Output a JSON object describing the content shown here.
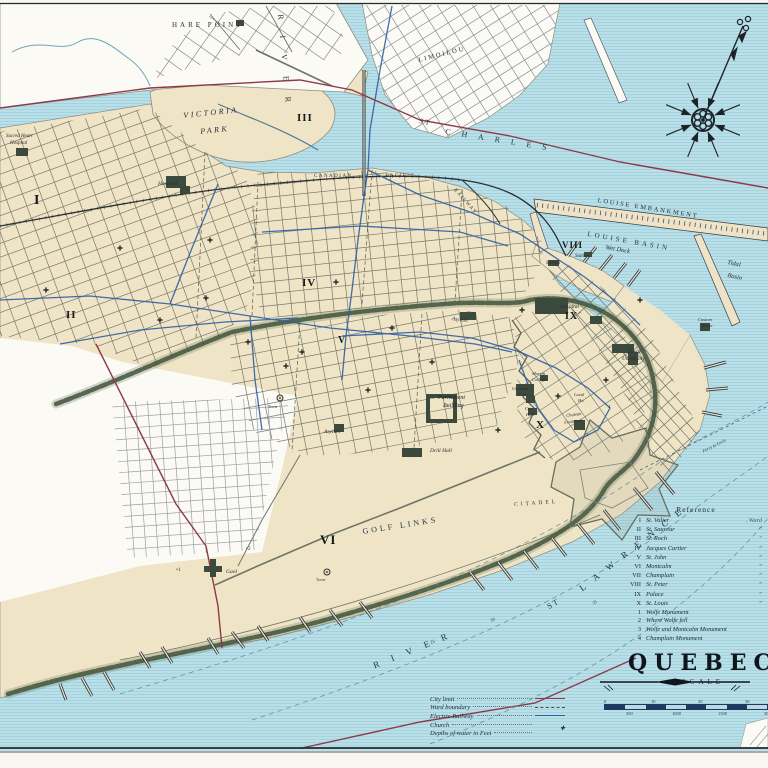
{
  "title": "QUEBEC",
  "scale": {
    "label": "SCALE",
    "top_ticks": [
      "0",
      "10",
      "20",
      "30"
    ],
    "bottom_ticks": [
      "500",
      "1000",
      "1500",
      "2000"
    ]
  },
  "legend": {
    "items": [
      {
        "label": "City limit",
        "type": "city-limit",
        "color": "#8c3a4a"
      },
      {
        "label": "Ward boundary",
        "type": "ward-boundary",
        "color": "#474c44"
      },
      {
        "label": "Electric Railway",
        "type": "electric-railway",
        "color": "#2e5fa3"
      },
      {
        "label": "Church",
        "type": "church",
        "symbol": "✚"
      },
      {
        "label": "Depths of water in Feet",
        "type": "none"
      }
    ]
  },
  "reference": {
    "title": "Reference",
    "ward_word": "Ward",
    "ditto": "”",
    "wards": [
      {
        "numeral": "I",
        "name": "St. Valier"
      },
      {
        "numeral": "II",
        "name": "St. Sauveur"
      },
      {
        "numeral": "III",
        "name": "St. Roch"
      },
      {
        "numeral": "IV",
        "name": "Jacques Cartier"
      },
      {
        "numeral": "V",
        "name": "St. John"
      },
      {
        "numeral": "VI",
        "name": "Montcalm"
      },
      {
        "numeral": "VII",
        "name": "Champlain"
      },
      {
        "numeral": "VIII",
        "name": "St. Peter"
      },
      {
        "numeral": "IX",
        "name": "Palace"
      },
      {
        "numeral": "X",
        "name": "St. Louis"
      }
    ],
    "monuments": [
      {
        "num": "1",
        "name": "Wolfe Monument"
      },
      {
        "num": "2",
        "name": "Where Wolfe fell"
      },
      {
        "num": "3",
        "name": "Wolfe and Montcalm Monument"
      },
      {
        "num": "4",
        "name": "Champlain Monument"
      }
    ]
  },
  "colors": {
    "water": "#b9dfe9",
    "water_line": "#97c8d5",
    "land": "#f0e4c6",
    "blank": "#fbfaf5",
    "cliff": "#41523c",
    "city_limit": "#8c3a4a",
    "electric": "#2e5fa3",
    "street": "#757b6c",
    "building": "#3c4a3e",
    "ink": "#23282f"
  },
  "map_labels": [
    {
      "t": "HARE  POINT",
      "x": 172,
      "y": 22,
      "s": 7,
      "ls": 3,
      "cls": "lb-caps"
    },
    {
      "t": "VICTORIA",
      "x": 183,
      "y": 112,
      "s": 8,
      "ls": 2.5,
      "r": -6,
      "cls": "lb-italic"
    },
    {
      "t": "PARK",
      "x": 200,
      "y": 128,
      "s": 8,
      "ls": 2.5,
      "r": -6,
      "cls": "lb-italic"
    },
    {
      "t": "RIVER",
      "x": 284,
      "y": 14,
      "s": 8,
      "ls": 16,
      "r": 85,
      "cls": "lb-water"
    },
    {
      "t": "ST",
      "x": 420,
      "y": 118,
      "s": 7,
      "ls": 2,
      "r": 12,
      "cls": "lb-water"
    },
    {
      "t": "CHARLES",
      "x": 446,
      "y": 128,
      "s": 8,
      "ls": 11,
      "r": 9,
      "cls": "lb-water"
    },
    {
      "t": "LIMOILOU",
      "x": 418,
      "y": 58,
      "s": 6.5,
      "ls": 2,
      "r": -14,
      "cls": "lb-caps"
    },
    {
      "t": "LOUISE  EMBANKMENT",
      "x": 598,
      "y": 198,
      "s": 6.5,
      "ls": 1.8,
      "r": 9,
      "cls": "lb-caps"
    },
    {
      "t": "LOUISE  BASIN",
      "x": 588,
      "y": 231,
      "s": 7,
      "ls": 3,
      "r": 10,
      "cls": "lb-water"
    },
    {
      "t": "Wet Dock",
      "x": 606,
      "y": 245,
      "s": 6.5,
      "r": 10,
      "cls": "lb-italic"
    },
    {
      "t": "Tidal",
      "x": 728,
      "y": 260,
      "s": 6.5,
      "r": 12,
      "cls": "lb-italic"
    },
    {
      "t": "Basin",
      "x": 728,
      "y": 273,
      "s": 6.5,
      "r": 12,
      "cls": "lb-italic"
    },
    {
      "t": "CANADIAN",
      "x": 314,
      "y": 174,
      "s": 5,
      "ls": 1.5,
      "cls": "lb-caps"
    },
    {
      "t": "PACIFIC",
      "x": 386,
      "y": 174,
      "s": 5,
      "ls": 1.5,
      "cls": "lb-caps"
    },
    {
      "t": "RAILWAY",
      "x": 456,
      "y": 188,
      "s": 5,
      "ls": 1.5,
      "r": 48,
      "cls": "lb-caps"
    },
    {
      "t": "Station",
      "x": 575,
      "y": 254,
      "s": 5,
      "cls": "lb-italic"
    },
    {
      "t": "Station",
      "x": 546,
      "y": 261,
      "s": 5,
      "cls": "lb-italic"
    },
    {
      "t": "Hospital",
      "x": 158,
      "y": 182,
      "s": 5.5,
      "cls": "lb-place"
    },
    {
      "t": "Sacred Heart",
      "x": 6,
      "y": 134,
      "s": 5,
      "cls": "lb-place"
    },
    {
      "t": "Hospital",
      "x": 10,
      "y": 141,
      "s": 5,
      "cls": "lb-place"
    },
    {
      "t": "Hospital",
      "x": 560,
      "y": 305,
      "s": 5.5,
      "cls": "lb-place"
    },
    {
      "t": "Laval",
      "x": 628,
      "y": 350,
      "s": 5.5,
      "cls": "lb-place"
    },
    {
      "t": "University",
      "x": 622,
      "y": 357,
      "s": 5.5,
      "cls": "lb-place"
    },
    {
      "t": "Morrin",
      "x": 532,
      "y": 372,
      "s": 4.5,
      "cls": "lb-place"
    },
    {
      "t": "College",
      "x": 532,
      "y": 378,
      "s": 4.5,
      "cls": "lb-place"
    },
    {
      "t": "Ursuline",
      "x": 512,
      "y": 387,
      "s": 4.5,
      "cls": "lb-place"
    },
    {
      "t": "Con.",
      "x": 519,
      "y": 393,
      "s": 4.5,
      "cls": "lb-place"
    },
    {
      "t": "City",
      "x": 525,
      "y": 407,
      "s": 4.5,
      "cls": "lb-place"
    },
    {
      "t": "Hall",
      "x": 526,
      "y": 413,
      "s": 4.5,
      "cls": "lb-place"
    },
    {
      "t": "Chateau",
      "x": 566,
      "y": 414,
      "s": 4.5,
      "r": -8,
      "cls": "lb-place"
    },
    {
      "t": "Frontenac",
      "x": 564,
      "y": 421,
      "s": 4.5,
      "r": -8,
      "cls": "lb-place"
    },
    {
      "t": "Laval",
      "x": 574,
      "y": 393,
      "s": 4.5,
      "cls": "lb-place"
    },
    {
      "t": "Ho.",
      "x": 578,
      "y": 399,
      "s": 4.5,
      "cls": "lb-place"
    },
    {
      "t": "Custom",
      "x": 698,
      "y": 318,
      "s": 4.5,
      "cls": "lb-place"
    },
    {
      "t": "House",
      "x": 701,
      "y": 324,
      "s": 4.5,
      "cls": "lb-place"
    },
    {
      "t": "Asylum",
      "x": 452,
      "y": 317,
      "s": 5.5,
      "r": 8,
      "cls": "lb-place"
    },
    {
      "t": "Asylum",
      "x": 324,
      "y": 430,
      "s": 5.5,
      "cls": "lb-place"
    },
    {
      "t": "Parliament",
      "x": 438,
      "y": 395,
      "s": 6,
      "cls": "lb-place"
    },
    {
      "t": "Building",
      "x": 443,
      "y": 403,
      "s": 6,
      "cls": "lb-place"
    },
    {
      "t": "Drill Hall",
      "x": 430,
      "y": 449,
      "s": 5.5,
      "cls": "lb-place"
    },
    {
      "t": "CITADEL",
      "x": 514,
      "y": 503,
      "s": 5.5,
      "ls": 3,
      "r": -4,
      "cls": "lb-caps"
    },
    {
      "t": "GOLF  LINKS",
      "x": 362,
      "y": 528,
      "s": 8,
      "ls": 3,
      "r": -9,
      "cls": "lb-water"
    },
    {
      "t": "Gaol",
      "x": 226,
      "y": 570,
      "s": 5.5,
      "cls": "lb-place"
    },
    {
      "t": "RIVER",
      "x": 372,
      "y": 662,
      "s": 9,
      "ls": 13,
      "r": -22,
      "cls": "lb-water"
    },
    {
      "t": "ST",
      "x": 546,
      "y": 604,
      "s": 8,
      "ls": 2,
      "r": -30,
      "cls": "lb-water"
    },
    {
      "t": "LAWRENCE",
      "x": 578,
      "y": 586,
      "s": 9,
      "ls": 11,
      "r": -38,
      "cls": "lb-water"
    },
    {
      "t": "Ferry to Levis",
      "x": 702,
      "y": 450,
      "s": 4.5,
      "r": -27,
      "cls": "lb-italic"
    },
    {
      "t": "25",
      "x": 430,
      "y": 641,
      "s": 4.5,
      "r": -20,
      "cls": "lb-tiny"
    },
    {
      "t": "30",
      "x": 490,
      "y": 619,
      "s": 4.5,
      "r": -20,
      "cls": "lb-tiny"
    },
    {
      "t": "35",
      "x": 592,
      "y": 602,
      "s": 4.5,
      "r": -25,
      "cls": "lb-tiny"
    },
    {
      "t": "•1",
      "x": 176,
      "y": 568,
      "s": 5.5,
      "cls": "lb-tiny"
    },
    {
      "t": "•2",
      "x": 246,
      "y": 547,
      "s": 5.5,
      "cls": "lb-tiny"
    },
    {
      "t": "3",
      "x": 586,
      "y": 433,
      "s": 4.5,
      "cls": "lb-tiny"
    },
    {
      "t": "4",
      "x": 608,
      "y": 405,
      "s": 4.5,
      "cls": "lb-tiny"
    },
    {
      "t": "Tower",
      "x": 268,
      "y": 406,
      "s": 3.8,
      "cls": "lb-tiny"
    },
    {
      "t": "Tower",
      "x": 316,
      "y": 579,
      "s": 3.8,
      "cls": "lb-tiny"
    }
  ],
  "ward_numerals": [
    {
      "n": "I",
      "x": 34,
      "y": 194,
      "s": 14
    },
    {
      "n": "II",
      "x": 66,
      "y": 310,
      "s": 11
    },
    {
      "n": "III",
      "x": 297,
      "y": 113,
      "s": 11
    },
    {
      "n": "IV",
      "x": 302,
      "y": 278,
      "s": 11
    },
    {
      "n": "V",
      "x": 338,
      "y": 336,
      "s": 10
    },
    {
      "n": "VI",
      "x": 320,
      "y": 533,
      "s": 13
    },
    {
      "n": "VIII",
      "x": 562,
      "y": 241,
      "s": 9
    },
    {
      "n": "IX",
      "x": 565,
      "y": 312,
      "s": 10
    },
    {
      "n": "X",
      "x": 536,
      "y": 420,
      "s": 11
    }
  ]
}
